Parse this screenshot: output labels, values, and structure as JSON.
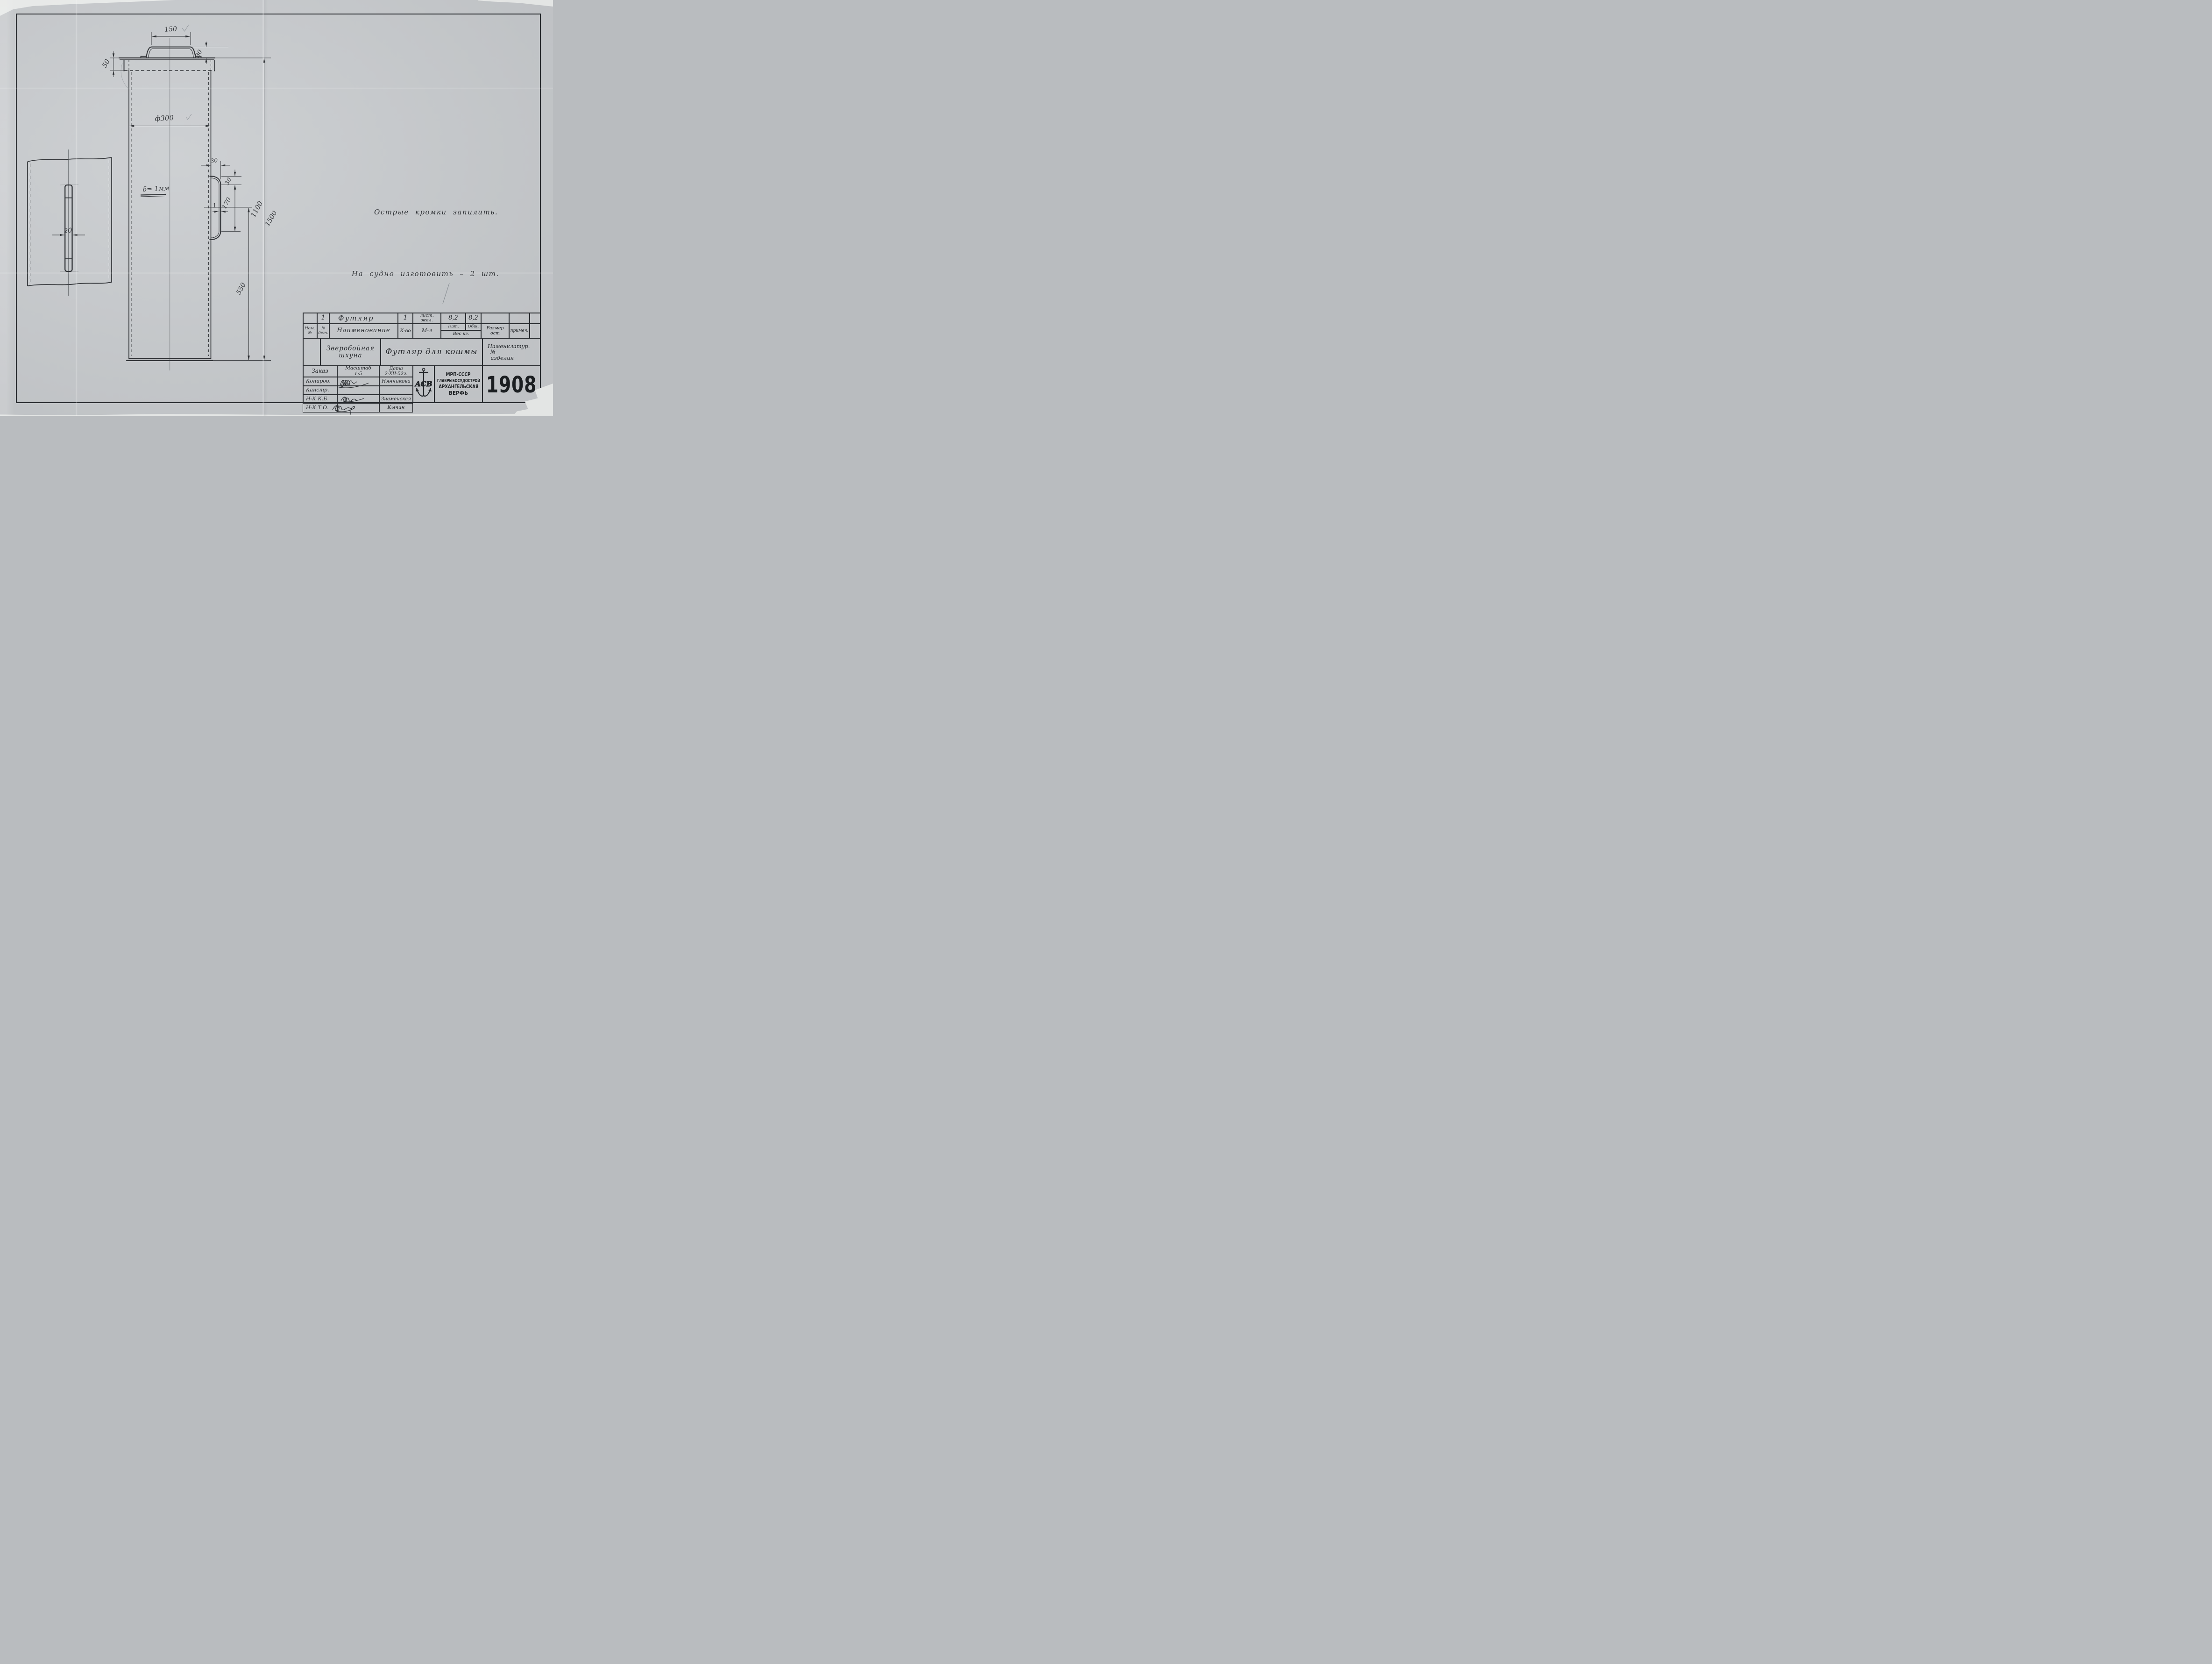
{
  "drawing": {
    "dim_150": "150",
    "dim_30_top": "30",
    "dim_50": "50",
    "dim_diameter": "ф300",
    "thickness_note": "δ= 1мм",
    "dim_30_offset": "30",
    "dim_30_foot": "30",
    "dim_170": "170",
    "dim_1": "1",
    "dim_550": "550",
    "dim_1100": "1100",
    "pencil_1500": "1500",
    "dim_20": "20",
    "note_edges": "Острые кромки запилить.",
    "note_qty": "На судно изготовить – 2 шт."
  },
  "title_block": {
    "row1": {
      "det_no": "1",
      "name": "Футляр",
      "qty": "1",
      "material_l1": "лист.",
      "material_l2": "жел.",
      "weight_each": "8,2",
      "weight_total": "8,2"
    },
    "headers": {
      "nom_no_l1": "Ном.",
      "nom_no_l2": "№",
      "det_no_l1": "№",
      "det_no_l2": "дет.",
      "name": "Наименование",
      "qty": "К-во",
      "material": "М-л",
      "per_item": "1шт.",
      "total": "Общ.",
      "weight": "Вес кг.",
      "size_l1": "Размер",
      "size_l2": "ост",
      "remark": "примеч."
    },
    "project": {
      "ship_l1": "Зверобойная",
      "ship_l2": "шхуна",
      "item": "Футляр для кошмы",
      "nom_l1": "Наменклатур.",
      "nom_l2": "№",
      "nom_l3": "изделия"
    },
    "footer": {
      "order": "Заказ",
      "scale_label": "Масштаб",
      "scale_value": "1:5",
      "date_label": "Дата",
      "date_value": "2-XII-52г.",
      "copied": "Копиров.",
      "copied_by": "Нянникова",
      "designed": "Канстр.",
      "nkkb": "Н-К.К.Б.",
      "nkkb_by": "Знаменская",
      "nkto": "Н-К Т.О.",
      "nkto_by": "Кычин",
      "org_l1": "МРП-СССР",
      "org_l2": "ГЛАВРЫБОСУДОСТРОЙ",
      "org_l3": "АРХАНГЕЛЬСКАЯ",
      "org_l4": "ВЕРФЬ",
      "emblem": "АСВ",
      "number": "1908"
    }
  }
}
